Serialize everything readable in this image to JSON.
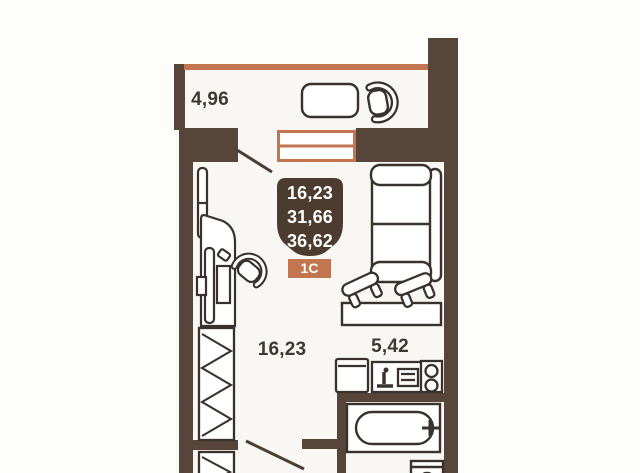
{
  "floorplan": {
    "title": "Планировка квартиры-студии 1С",
    "balcony": {
      "area": "4,96"
    },
    "room": {
      "area": "16,23"
    },
    "kitchen": {
      "area": "5,42"
    },
    "info_badge": {
      "line1": "16,23",
      "line2": "31,66",
      "line3": "36,62",
      "type_label": "1С"
    },
    "colors": {
      "wall": "#564538",
      "accent_orange": "#c1764f",
      "badge_dark": "#4c3b2f",
      "furniture_line": "#39322c",
      "label_text": "#3e3833",
      "interior_bg": "#f9f7f4"
    }
  }
}
